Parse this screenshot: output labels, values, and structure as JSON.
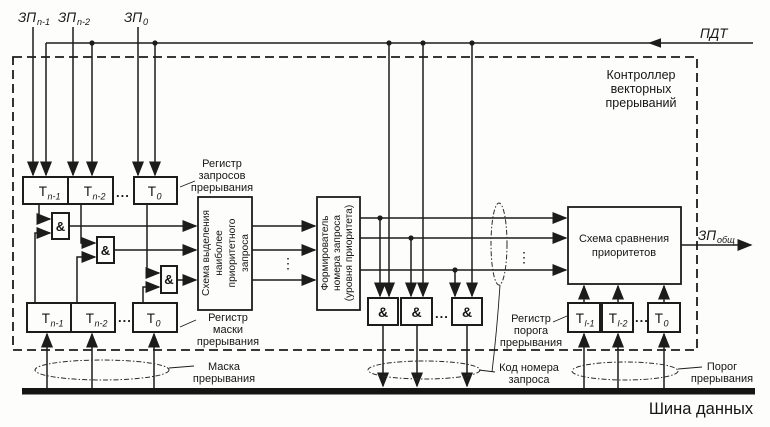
{
  "controller": {
    "title_lines": [
      "Контроллер",
      "векторных",
      "прерываний"
    ]
  },
  "signals": {
    "zp_hi": {
      "base": "ЗП",
      "sub": "n-1"
    },
    "zp_mid": {
      "base": "ЗП",
      "sub": "n-2"
    },
    "zp_lo": {
      "base": "ЗП",
      "sub": "0"
    },
    "pdt": "ПДТ",
    "zp_common": {
      "base": "ЗП",
      "sub": "общ"
    }
  },
  "request_register": {
    "label_lines": [
      "Регистр",
      "запросов",
      "прерывания"
    ],
    "cells": [
      {
        "base": "Т",
        "sub": "n-1"
      },
      {
        "base": "Т",
        "sub": "n-2"
      },
      {
        "base": "Т",
        "sub": "0"
      }
    ],
    "ellipsis": "..."
  },
  "mask_register": {
    "label_lines": [
      "Регистр",
      "маски",
      "прерывания"
    ],
    "cells": [
      {
        "base": "Т",
        "sub": "n-1"
      },
      {
        "base": "Т",
        "sub": "n-2"
      },
      {
        "base": "Т",
        "sub": "0"
      }
    ],
    "ellipsis": "..."
  },
  "threshold_register": {
    "label_lines": [
      "Регистр",
      "порога",
      "прерывания"
    ],
    "cells": [
      {
        "base": "Т",
        "sub": "l-1"
      },
      {
        "base": "Т",
        "sub": "l-2"
      },
      {
        "base": "Т",
        "sub": "0"
      }
    ],
    "ellipsis": "..."
  },
  "gates": {
    "and_symbol": "&",
    "ellipsis": "..."
  },
  "selector": {
    "lines": [
      "Схема выделения",
      "наиболее",
      "приоритетного",
      "запроса"
    ]
  },
  "former": {
    "lines": [
      "Формирователь",
      "номера запроса",
      "(уровня приоритета)"
    ]
  },
  "comparator": {
    "lines": [
      "Схема сравнения",
      "приоритетов"
    ]
  },
  "bus": {
    "label": "Шина данных"
  },
  "annotations": {
    "mask_lines": [
      "Маска",
      "прерывания"
    ],
    "code_lines": [
      "Код номера",
      "запроса"
    ],
    "threshold_lines": [
      "Порог",
      "прерывания"
    ],
    "vdots": "⋮"
  }
}
